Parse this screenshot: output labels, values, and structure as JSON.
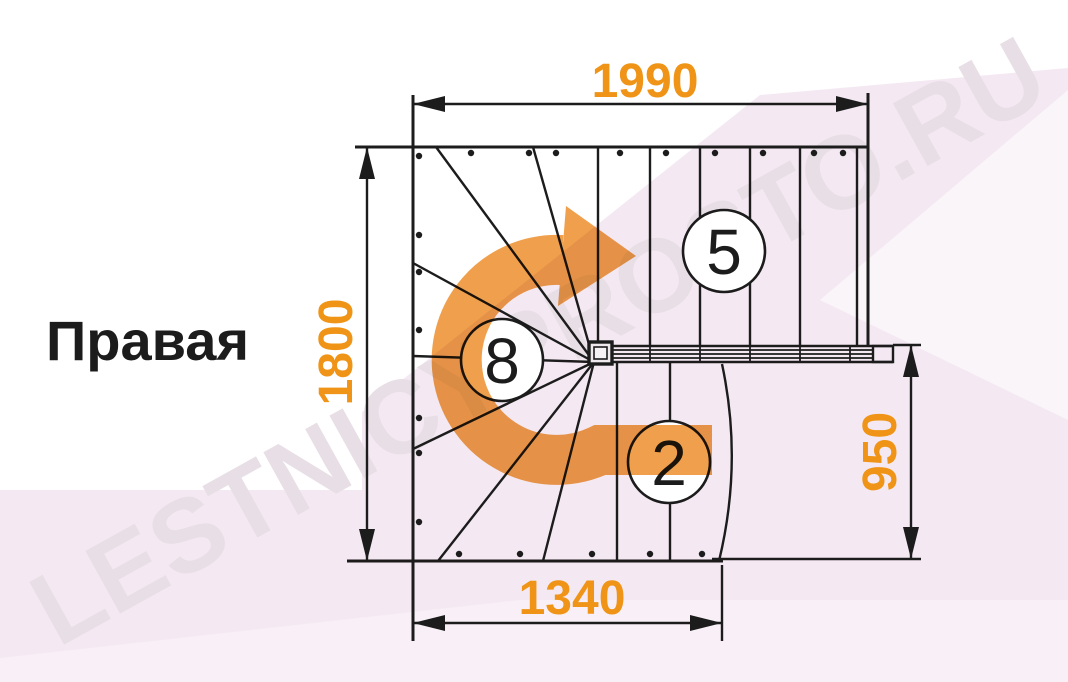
{
  "drawing_title": "Правая",
  "watermark_text": "LESTNICYPROSTO.RU",
  "dimensions": {
    "top_width": "1990",
    "left_height": "1800",
    "bottom_width": "1340",
    "right_height": "950"
  },
  "step_counts": {
    "top_flight": "5",
    "winder_turn": "8",
    "bottom_flight": "2"
  },
  "icons": {
    "turn_arrow": "curved-turn-direction-arrow"
  },
  "colors": {
    "dimension_text": "#EF9417",
    "turn_arrow": "#F0A04C",
    "drawing_line": "#1C1C1C",
    "watermark_band": "#F4E9F2",
    "watermark_letters": "#E8DEE5"
  }
}
